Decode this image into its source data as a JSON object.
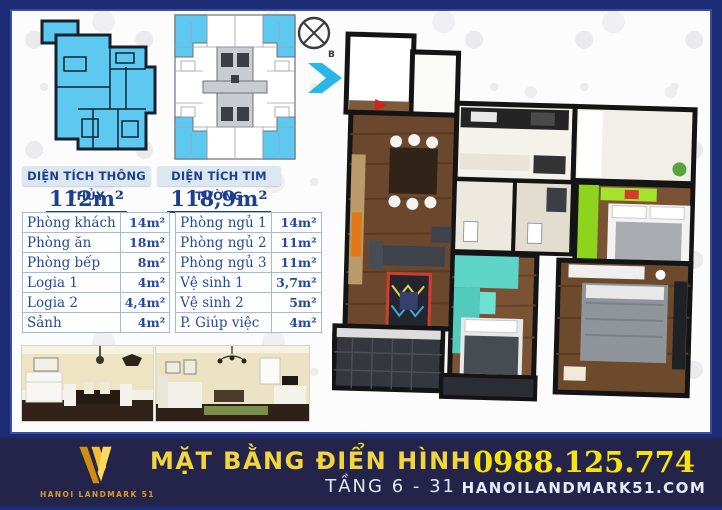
{
  "compass": {
    "north_label": "B"
  },
  "area_summary": {
    "net": {
      "label": "DIỆN TÍCH THÔNG THỦY",
      "value": "112m²"
    },
    "gross": {
      "label": "DIỆN TÍCH TIM TƯỜNG",
      "value": "118,9m²"
    }
  },
  "room_table": {
    "left_rows": [
      {
        "name": "Phòng khách",
        "area": "14m²"
      },
      {
        "name": "Phòng ăn",
        "area": "18m²"
      },
      {
        "name": "Phòng bếp",
        "area": "8m²"
      },
      {
        "name": "Logia 1",
        "area": "4m²"
      },
      {
        "name": "Logia 2",
        "area": "4,4m²"
      },
      {
        "name": "Sảnh",
        "area": "4m²"
      }
    ],
    "right_rows": [
      {
        "name": "Phòng ngủ 1",
        "area": "14m²"
      },
      {
        "name": "Phòng ngủ 2",
        "area": "11m²"
      },
      {
        "name": "Phòng ngủ 3",
        "area": "11m²"
      },
      {
        "name": "Vệ sinh 1",
        "area": "3,7m²"
      },
      {
        "name": "Vệ sinh 2",
        "area": "5m²"
      },
      {
        "name": "P. Giúp việc",
        "area": "4m²"
      }
    ]
  },
  "footer": {
    "logo_text": "HANOI LANDMARK 51",
    "title": "MẶT BẰNG ĐIỂN HÌNH",
    "subtitle": "TẦNG 6 - 31",
    "phone": "0988.125.774",
    "website": "HANOILANDMARK51.COM"
  },
  "colors": {
    "frame_navy": "#1c2c74",
    "footer_navy": "#24244a",
    "plan_blue": "#5dc9f1",
    "arrow_blue": "#29b7e8",
    "table_blue": "#224a9c",
    "gold": "#f0c239",
    "phone_yellow": "#f7e311",
    "bedroom_green": "#8fd41c",
    "bedroom_teal": "#5fd4c8"
  }
}
